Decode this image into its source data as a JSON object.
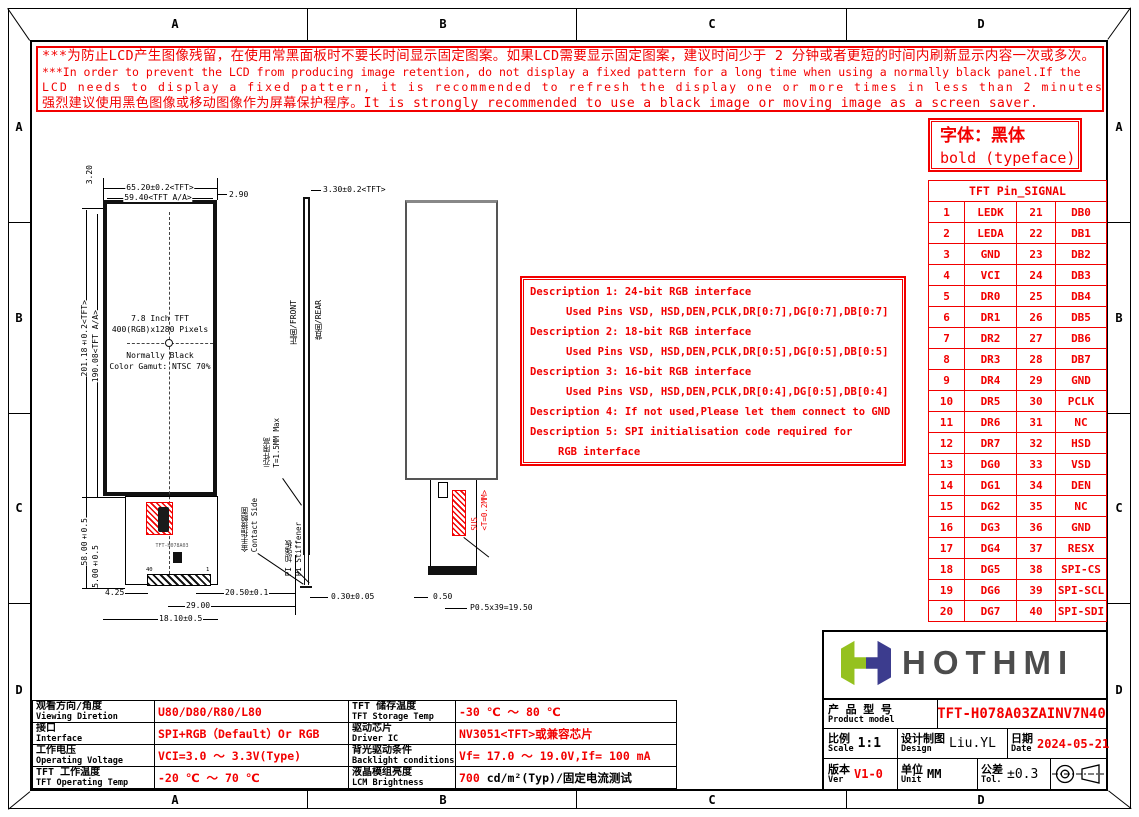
{
  "colors": {
    "red": "#f20000",
    "logo_green": "#95c11f",
    "logo_navy": "#3c3c8e",
    "logo_text": "#4c4c4c"
  },
  "frame": {
    "labels": [
      "A",
      "B",
      "C",
      "D"
    ]
  },
  "warning": {
    "lines": [
      "***为防止LCD产生图像残留，在使用常黑面板时不要长时间显示固定图案。如果LCD需要显示固定图案，建议时间少于 2 分钟或者更短的时间内刷新显示内容一次或多次。",
      "***In order to prevent the LCD from producing image retention, do not display a fixed pattern for a long time when using a normally black panel.If the",
      " LCD needs to display a fixed pattern, it is recommended to refresh the display one or more times in less than 2 minutes or less.",
      "强烈建议使用黑色图像或移动图像作为屏幕保护程序。It is strongly recommended to use a black image or moving image as a screen saver."
    ]
  },
  "font_note": {
    "line1": "字体：黑体",
    "line2": "bold (typeface)"
  },
  "descriptions": {
    "lines": [
      {
        "text": "Description 1: 24-bit RGB interface",
        "indent": 0
      },
      {
        "text": "Used Pins VSD, HSD,DEN,PCLK,DR[0:7],DG[0:7],DB[0:7]",
        "indent": 1
      },
      {
        "text": "Description 2: 18-bit RGB interface",
        "indent": 0
      },
      {
        "text": "Used Pins VSD, HSD,DEN,PCLK,DR[0:5],DG[0:5],DB[0:5]",
        "indent": 1
      },
      {
        "text": "Description 3: 16-bit RGB interface",
        "indent": 0
      },
      {
        "text": "Used Pins VSD, HSD,DEN,PCLK,DR[0:4],DG[0:5],DB[0:4]",
        "indent": 1
      },
      {
        "text": "Description 4: If not used,Please let them connect to GND",
        "indent": 0
      },
      {
        "text": "Description 5: SPI initialisation code required for",
        "indent": 0
      },
      {
        "text": "RGB interface",
        "indent": 2
      }
    ]
  },
  "pin_table": {
    "title": "TFT Pin_SIGNAL",
    "rows": [
      [
        "1",
        "LEDK",
        "21",
        "DB0"
      ],
      [
        "2",
        "LEDA",
        "22",
        "DB1"
      ],
      [
        "3",
        "GND",
        "23",
        "DB2"
      ],
      [
        "4",
        "VCI",
        "24",
        "DB3"
      ],
      [
        "5",
        "DR0",
        "25",
        "DB4"
      ],
      [
        "6",
        "DR1",
        "26",
        "DB5"
      ],
      [
        "7",
        "DR2",
        "27",
        "DB6"
      ],
      [
        "8",
        "DR3",
        "28",
        "DB7"
      ],
      [
        "9",
        "DR4",
        "29",
        "GND"
      ],
      [
        "10",
        "DR5",
        "30",
        "PCLK"
      ],
      [
        "11",
        "DR6",
        "31",
        "NC"
      ],
      [
        "12",
        "DR7",
        "32",
        "HSD"
      ],
      [
        "13",
        "DG0",
        "33",
        "VSD"
      ],
      [
        "14",
        "DG1",
        "34",
        "DEN"
      ],
      [
        "15",
        "DG2",
        "35",
        "NC"
      ],
      [
        "16",
        "DG3",
        "36",
        "GND"
      ],
      [
        "17",
        "DG4",
        "37",
        "RESX"
      ],
      [
        "18",
        "DG5",
        "38",
        "SPI-CS"
      ],
      [
        "19",
        "DG6",
        "39",
        "SPI-SCL"
      ],
      [
        "20",
        "DG7",
        "40",
        "SPI-SDI"
      ]
    ]
  },
  "drawing": {
    "panel_lines": [
      "7.8 Inch TFT",
      "400(RGB)x1280 Pixels",
      "Normally Black",
      "Color Gamut: NTSC 70%"
    ],
    "dims": {
      "top_width": "65.20±0.2<TFT>",
      "top_aa": "59.40<TFT A/A>",
      "right_offset": "2.90",
      "top_offset": "3.20",
      "height": "201.18±0.2<TFT>",
      "height_aa": "190.08<TFT A/A>",
      "fpc_len": "58.00±0.5",
      "fpc_step": "5.00±0.5",
      "bot_a": "4.25",
      "bot_b": "20.50±0.1",
      "bot_c": "29.00",
      "bot_d": "18.10±0.5"
    },
    "side": {
      "thickness": "3.30±0.2<TFT>",
      "front": "正面/FRONT",
      "rear": "背面/REAR",
      "comp_cn": "元件限高",
      "comp_en": "T=1.5MM Max",
      "contact_cn": "金手指接触面",
      "contact_en": "Contact Side",
      "stiff_cn": "PI 加强板",
      "stiff_en": "PI Stiffener",
      "bottom": "0.30±0.05"
    },
    "rear": {
      "sus_line1": "SUS",
      "sus_line2": "<T=0.2MM>",
      "strip": "0.50",
      "pitch": "P0.5x39=19.50"
    },
    "fpc": {
      "marking": "TFT-H078A03",
      "pin_left": "40",
      "pin_right": "1"
    }
  },
  "spec_left": {
    "rows": [
      {
        "cn": "观看方向/角度",
        "en": "Viewing Diretion",
        "value": "U80/D80/R80/L80",
        "suffix": ""
      },
      {
        "cn": "接口",
        "en": "Interface",
        "value": "SPI+RGB（Default）Or RGB",
        "suffix": ""
      },
      {
        "cn": "工作电压",
        "en": "Operating Voltage",
        "value": "VCI=3.0 ～ 3.3V(Type)",
        "suffix": ""
      },
      {
        "cn": "TFT 工作温度",
        "en": "TFT Operating Temp",
        "value": "-20 ℃ ～ 70 ℃",
        "suffix": ""
      }
    ]
  },
  "spec_right": {
    "rows": [
      {
        "cn": "TFT 储存温度",
        "en": "TFT Storage Temp",
        "value": "-30 ℃ ～ 80 ℃",
        "suffix": ""
      },
      {
        "cn": "驱动芯片",
        "en": "Driver IC",
        "value": "NV3051<TFT>或兼容芯片",
        "suffix": ""
      },
      {
        "cn": "背光驱动条件",
        "en": "Backlight conditions",
        "value": "Vf= 17.0 ～ 19.0V,If= 100 mA",
        "suffix": ""
      },
      {
        "cn": "液晶模组亮度",
        "en": "LCM Brightness",
        "value": "700",
        "suffix": " cd/m²(Typ)/固定电流测试"
      }
    ]
  },
  "title_block": {
    "logo_text": "HOTHMI",
    "product_label_cn": "产 品 型 号",
    "product_label_en": "Product model",
    "model": "TFT-H078A03ZAINV7N40",
    "scale_cn": "比例",
    "scale_en": "Scale",
    "scale_value": "1:1",
    "design_cn": "设计制图",
    "design_en": "Design",
    "design_value": "Liu.YL",
    "date_cn": "日期",
    "date_en": "Date",
    "date_value": "2024-05-21",
    "ver_cn": "版本",
    "ver_en": "Ver",
    "ver_value": "V1-0",
    "unit_cn": "单位",
    "unit_en": "Unit",
    "unit_value": "MM",
    "tol_cn": "公差",
    "tol_en": "Tol.",
    "tol_value": "±0.3"
  }
}
